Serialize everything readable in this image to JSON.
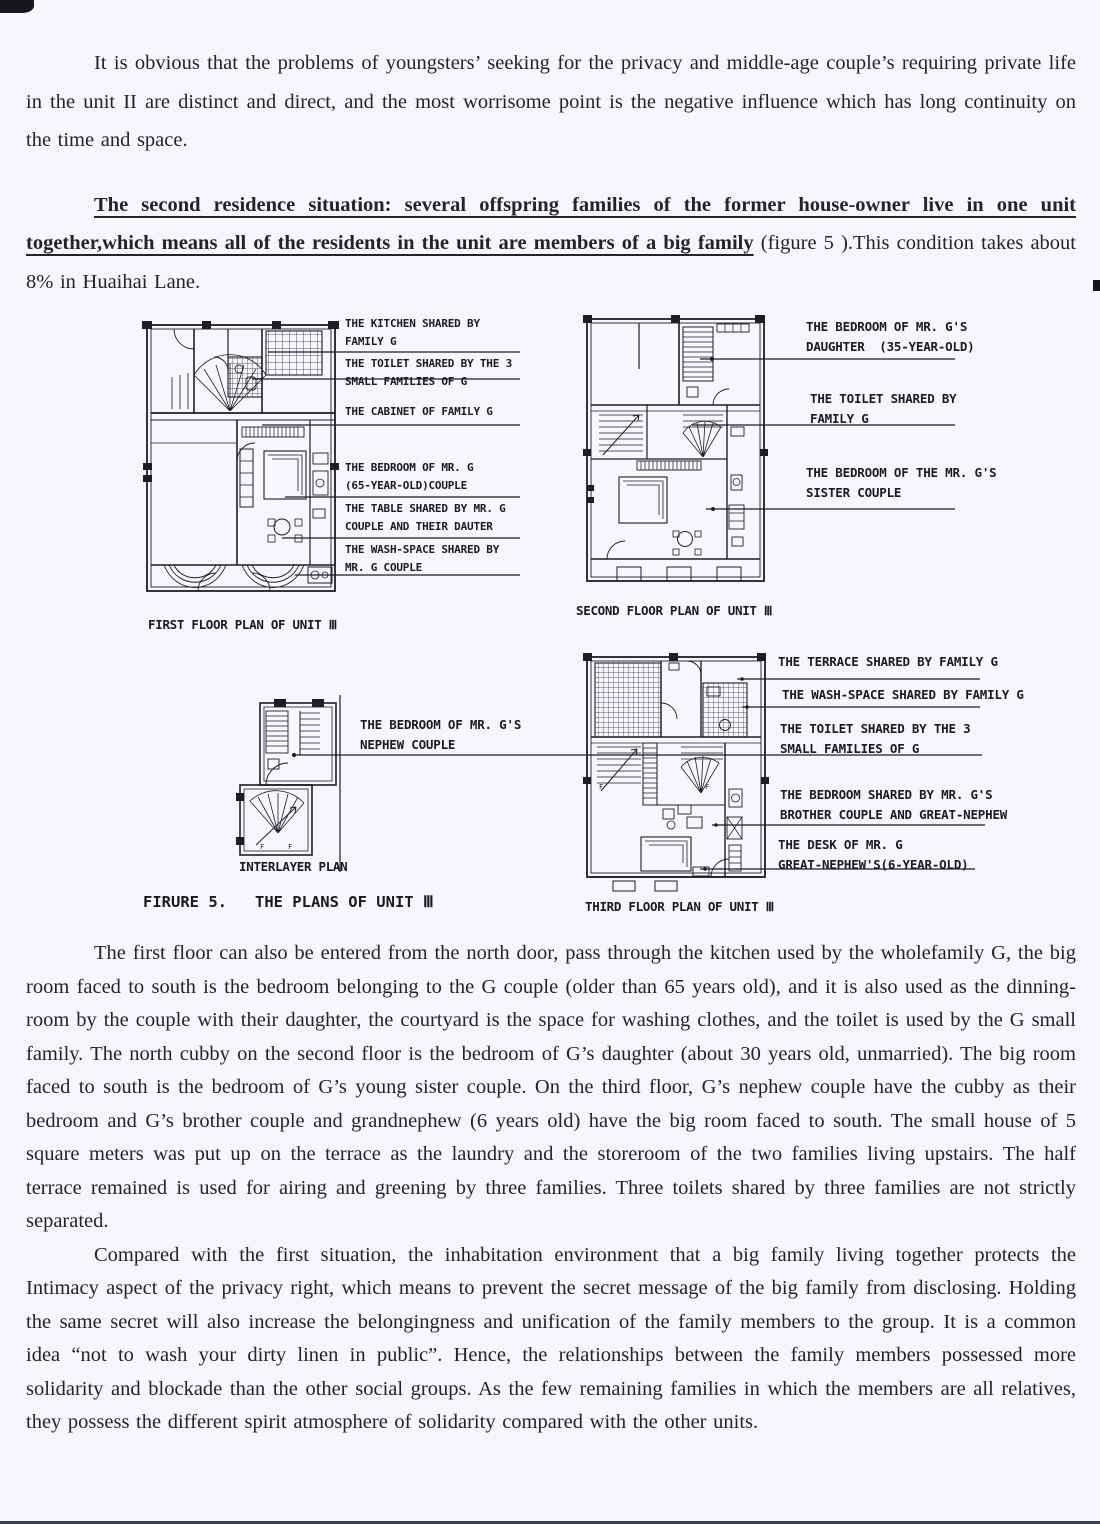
{
  "paragraphs": {
    "p1": "It is obvious that the problems of youngsters’ seeking for the privacy and middle-age couple’s requiring private life in the unit II are distinct and direct, and the most worrisome point is the negative influence which has long continuity on the time and space.",
    "p2": "The first floor can also be entered from the north door, pass through the kitchen used by the wholefamily G, the big room faced to south is the bedroom belonging to the G couple (older than 65 years old), and it is also used as the dinning-room by the couple with their daughter, the courtyard is the space for washing clothes, and the toilet is used by the G small family. The north cubby on the second floor is the bedroom of G’s daughter (about 30 years old, unmarried). The big room faced to south is the bedroom of G’s young sister couple. On the third floor, G’s nephew couple have the cubby as their bedroom and G’s brother couple and grandnephew (6 years old) have the big room faced to south. The small house of 5 square meters was put up on the terrace as the laundry and the storeroom of the two families living upstairs. The half terrace remained is used for airing and greening by three families. Three toilets shared by three families are not strictly separated.",
    "p3": "Compared with the first situation, the inhabitation environment that a big family living together protects the Intimacy aspect of the privacy right, which means to prevent the secret message of the big family from disclosing. Holding the same secret will also increase the belongingness and unification of the family members to the group. It is a common idea “not to wash your dirty linen in public”. Hence, the relationships between the family members possessed more solidarity and blockade than the other social groups. As the few remaining families in which the members are all relatives, they possess the different spirit atmosphere of solidarity compared with the other units."
  },
  "heading": {
    "underlined": "The second residence situation: several offspring families of the former house-owner live in one unit together,which means all of the residents in the unit are members of a big family",
    "rest": " (figure 5 ).This condition takes about 8% in Huaihai Lane."
  },
  "figure": {
    "caption": "FIRURE 5.   THE PLANS OF UNIT Ⅲ",
    "first_floor": {
      "caption": "FIRST FLOOR PLAN OF UNIT Ⅲ",
      "labels": [
        [
          "THE KITCHEN SHARED BY",
          "FAMILY G"
        ],
        [
          "THE TOILET SHARED BY THE 3",
          "SMALL FAMILIES OF G"
        ],
        [
          "THE CABINET OF FAMILY G"
        ],
        [
          "THE BEDROOM OF MR. G",
          "(65-YEAR-OLD)COUPLE"
        ],
        [
          "THE TABLE SHARED BY MR. G",
          "COUPLE AND THEIR DAUTER"
        ],
        [
          "THE WASH-SPACE SHARED BY",
          "MR. G COUPLE"
        ]
      ]
    },
    "second_floor": {
      "caption": "SECOND FLOOR PLAN OF UNIT Ⅲ",
      "labels": [
        [
          "THE BEDROOM OF MR. G'S",
          "DAUGHTER  (35-YEAR-OLD)"
        ],
        [
          "THE TOILET SHARED BY",
          "FAMILY G"
        ],
        [
          "THE BEDROOM OF THE MR. G'S",
          "SISTER COUPLE"
        ]
      ]
    },
    "interlayer": {
      "caption": "INTERLAYER PLAN",
      "labels": [
        [
          "THE BEDROOM OF MR. G'S",
          "NEPHEW COUPLE"
        ]
      ]
    },
    "third_floor": {
      "caption": "THIRD FLOOR PLAN OF UNIT Ⅲ",
      "labels": [
        [
          "THE TERRACE SHARED BY FAMILY G"
        ],
        [
          "THE WASH-SPACE SHARED BY FAMILY G"
        ],
        [
          "THE TOILET SHARED BY THE 3",
          "SMALL FAMILIES OF G"
        ],
        [
          "THE BEDROOM SHARED BY MR. G'S",
          "BROTHER COUPLE AND GREAT-NEPHEW"
        ],
        [
          "THE DESK OF MR. G",
          "GREAT-NEPHEW'S(6-YEAR-OLD)"
        ]
      ]
    }
  }
}
